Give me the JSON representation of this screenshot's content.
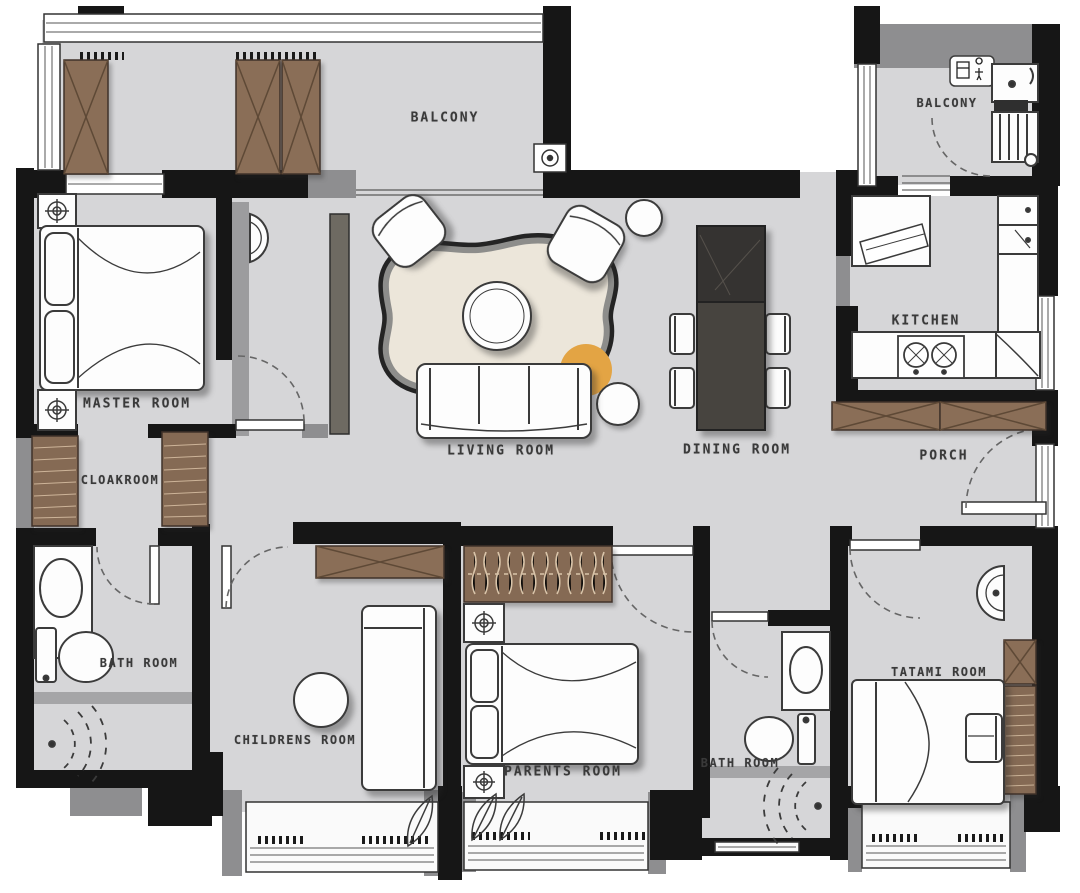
{
  "title": "apartment floor plan",
  "rooms": [
    {
      "id": "balcony-left",
      "label": "BALCONY"
    },
    {
      "id": "balcony-right",
      "label": "BALCONY"
    },
    {
      "id": "master-room",
      "label": "MASTER ROOM"
    },
    {
      "id": "cloakroom",
      "label": "CLOAKROOM"
    },
    {
      "id": "living-room",
      "label": "LIVING ROOM"
    },
    {
      "id": "dining-room",
      "label": "DINING ROOM"
    },
    {
      "id": "kitchen",
      "label": "KITCHEN"
    },
    {
      "id": "porch",
      "label": "PORCH"
    },
    {
      "id": "bath-room-left",
      "label": "BATH ROOM"
    },
    {
      "id": "childrens-room",
      "label": "CHILDRENS ROOM"
    },
    {
      "id": "parents-room",
      "label": "PARENTS ROOM"
    },
    {
      "id": "bath-room-right",
      "label": "BATH ROOM"
    },
    {
      "id": "tatami-room",
      "label": "TATAMI ROOM"
    }
  ],
  "colors": {
    "wall": "#161616",
    "wall_secondary": "#8e8e90",
    "floor": "#d6d6d8",
    "wood": "#8a6e57",
    "wood_line": "#d8c3a8",
    "dining_table": "#3c3936",
    "accent_orange": "#e3a444",
    "rug_fill": "#ece6da",
    "label_text": "#3a3a3a"
  }
}
